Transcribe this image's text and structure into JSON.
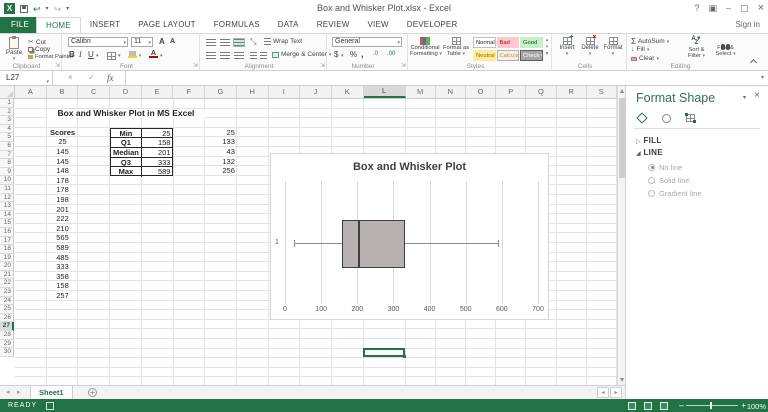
{
  "titlebar": {
    "title": "Box and Whisker Plot.xlsx - Excel",
    "sign_in": "Sign in"
  },
  "tabs": {
    "file": "FILE",
    "active": "HOME",
    "others": [
      "INSERT",
      "PAGE LAYOUT",
      "FORMULAS",
      "DATA",
      "REVIEW",
      "VIEW",
      "DEVELOPER"
    ]
  },
  "ribbon": {
    "clipboard": {
      "label": "Clipboard",
      "paste": "Paste",
      "cut": "Cut",
      "copy": "Copy",
      "painter": "Format Painter"
    },
    "font": {
      "label": "Font",
      "family": "Calibri",
      "size": "11",
      "bold": "B",
      "italic": "I",
      "underline": "U",
      "grow": "A",
      "shrink": "A"
    },
    "alignment": {
      "label": "Alignment",
      "wrap": "Wrap Text",
      "merge": "Merge & Center"
    },
    "number": {
      "label": "Number",
      "format": "General",
      "currency": "$",
      "percent": "%",
      "comma": ",",
      "inc_dec": ".0",
      "dec_dec": ".00"
    },
    "styles": {
      "label": "Styles",
      "conditional_1": "Conditional",
      "conditional_2": "Formatting",
      "table_1": "Format as",
      "table_2": "Table",
      "gallery": [
        {
          "name": "Normal",
          "bg": "#ffffff",
          "fg": "#1f1f1f",
          "border": "#b9c4d1"
        },
        {
          "name": "Bad",
          "bg": "#ffc7ce",
          "fg": "#9c0006",
          "border": "#ffc7ce"
        },
        {
          "name": "Good",
          "bg": "#c6efce",
          "fg": "#006100",
          "border": "#c6efce"
        },
        {
          "name": "Neutral",
          "bg": "#ffeb9c",
          "fg": "#9c6500",
          "border": "#ffeb9c"
        },
        {
          "name": "Calculation",
          "bg": "#f2f2f2",
          "fg": "#fa7d00",
          "border": "#b0b0b0"
        },
        {
          "name": "Check Cell",
          "bg": "#a5a5a5",
          "fg": "#ffffff",
          "border": "#5f5f5f"
        }
      ]
    },
    "cells": {
      "label": "Cells",
      "insert": "Insert",
      "delete": "Delete",
      "format": "Format"
    },
    "editing": {
      "label": "Editing",
      "sigma": "Σ",
      "autosum": "AutoSum",
      "fill": "Fill",
      "clear": "Clear",
      "sort_1": "Sort &",
      "sort_2": "Filter",
      "find_1": "Find &",
      "find_2": "Select"
    }
  },
  "formula_bar": {
    "name_box": "L27",
    "fx": "fx"
  },
  "grid": {
    "col_headers": [
      "A",
      "B",
      "C",
      "D",
      "E",
      "F",
      "G",
      "H",
      "I",
      "J",
      "K",
      "L",
      "M",
      "N",
      "O",
      "P",
      "Q",
      "R",
      "S"
    ],
    "selected_col": "L",
    "row_count": 30,
    "selected_row": 27,
    "selected_cell": "L27",
    "sheet_title": "Box and Whisker Plot in MS Excel",
    "scores_label": "Scores",
    "scores": [
      25,
      145,
      145,
      148,
      178,
      178,
      198,
      201,
      222,
      210,
      565,
      589,
      485,
      333,
      358,
      158,
      257
    ],
    "stats_table": {
      "rows": [
        {
          "label": "Min",
          "value": "25",
          "extra": "25"
        },
        {
          "label": "Q1",
          "value": "158",
          "extra": "133"
        },
        {
          "label": "Median",
          "value": "201",
          "extra": "43"
        },
        {
          "label": "Q3",
          "value": "333",
          "extra": "132"
        },
        {
          "label": "Max",
          "value": "589",
          "extra": "256"
        }
      ]
    }
  },
  "chart_data": {
    "type": "box",
    "orientation": "horizontal",
    "title": "Box and Whisker Plot",
    "category_label": "1",
    "stats": {
      "min": 25,
      "q1": 158,
      "median": 201,
      "q3": 333,
      "max": 589
    },
    "xlim": [
      0,
      700
    ],
    "xticks": [
      0,
      100,
      200,
      300,
      400,
      500,
      600,
      700
    ],
    "grid": true,
    "colors": {
      "box_fill": "#b7b1b1",
      "box_border": "#3f3f3f",
      "whisker": "#8c8c8c",
      "gridline": "#dcdcdc",
      "text": "#595959",
      "title": "#404040"
    }
  },
  "sheet_tabs": {
    "active": "Sheet1"
  },
  "status_bar": {
    "mode": "READY",
    "zoom_level": "100%"
  },
  "panel": {
    "title": "Format Shape",
    "fill_section": "FILL",
    "line_section": "LINE",
    "line_options": [
      {
        "label": "No line",
        "selected": true
      },
      {
        "label": "Solid line",
        "selected": false
      },
      {
        "label": "Gradient line",
        "selected": false
      }
    ]
  }
}
